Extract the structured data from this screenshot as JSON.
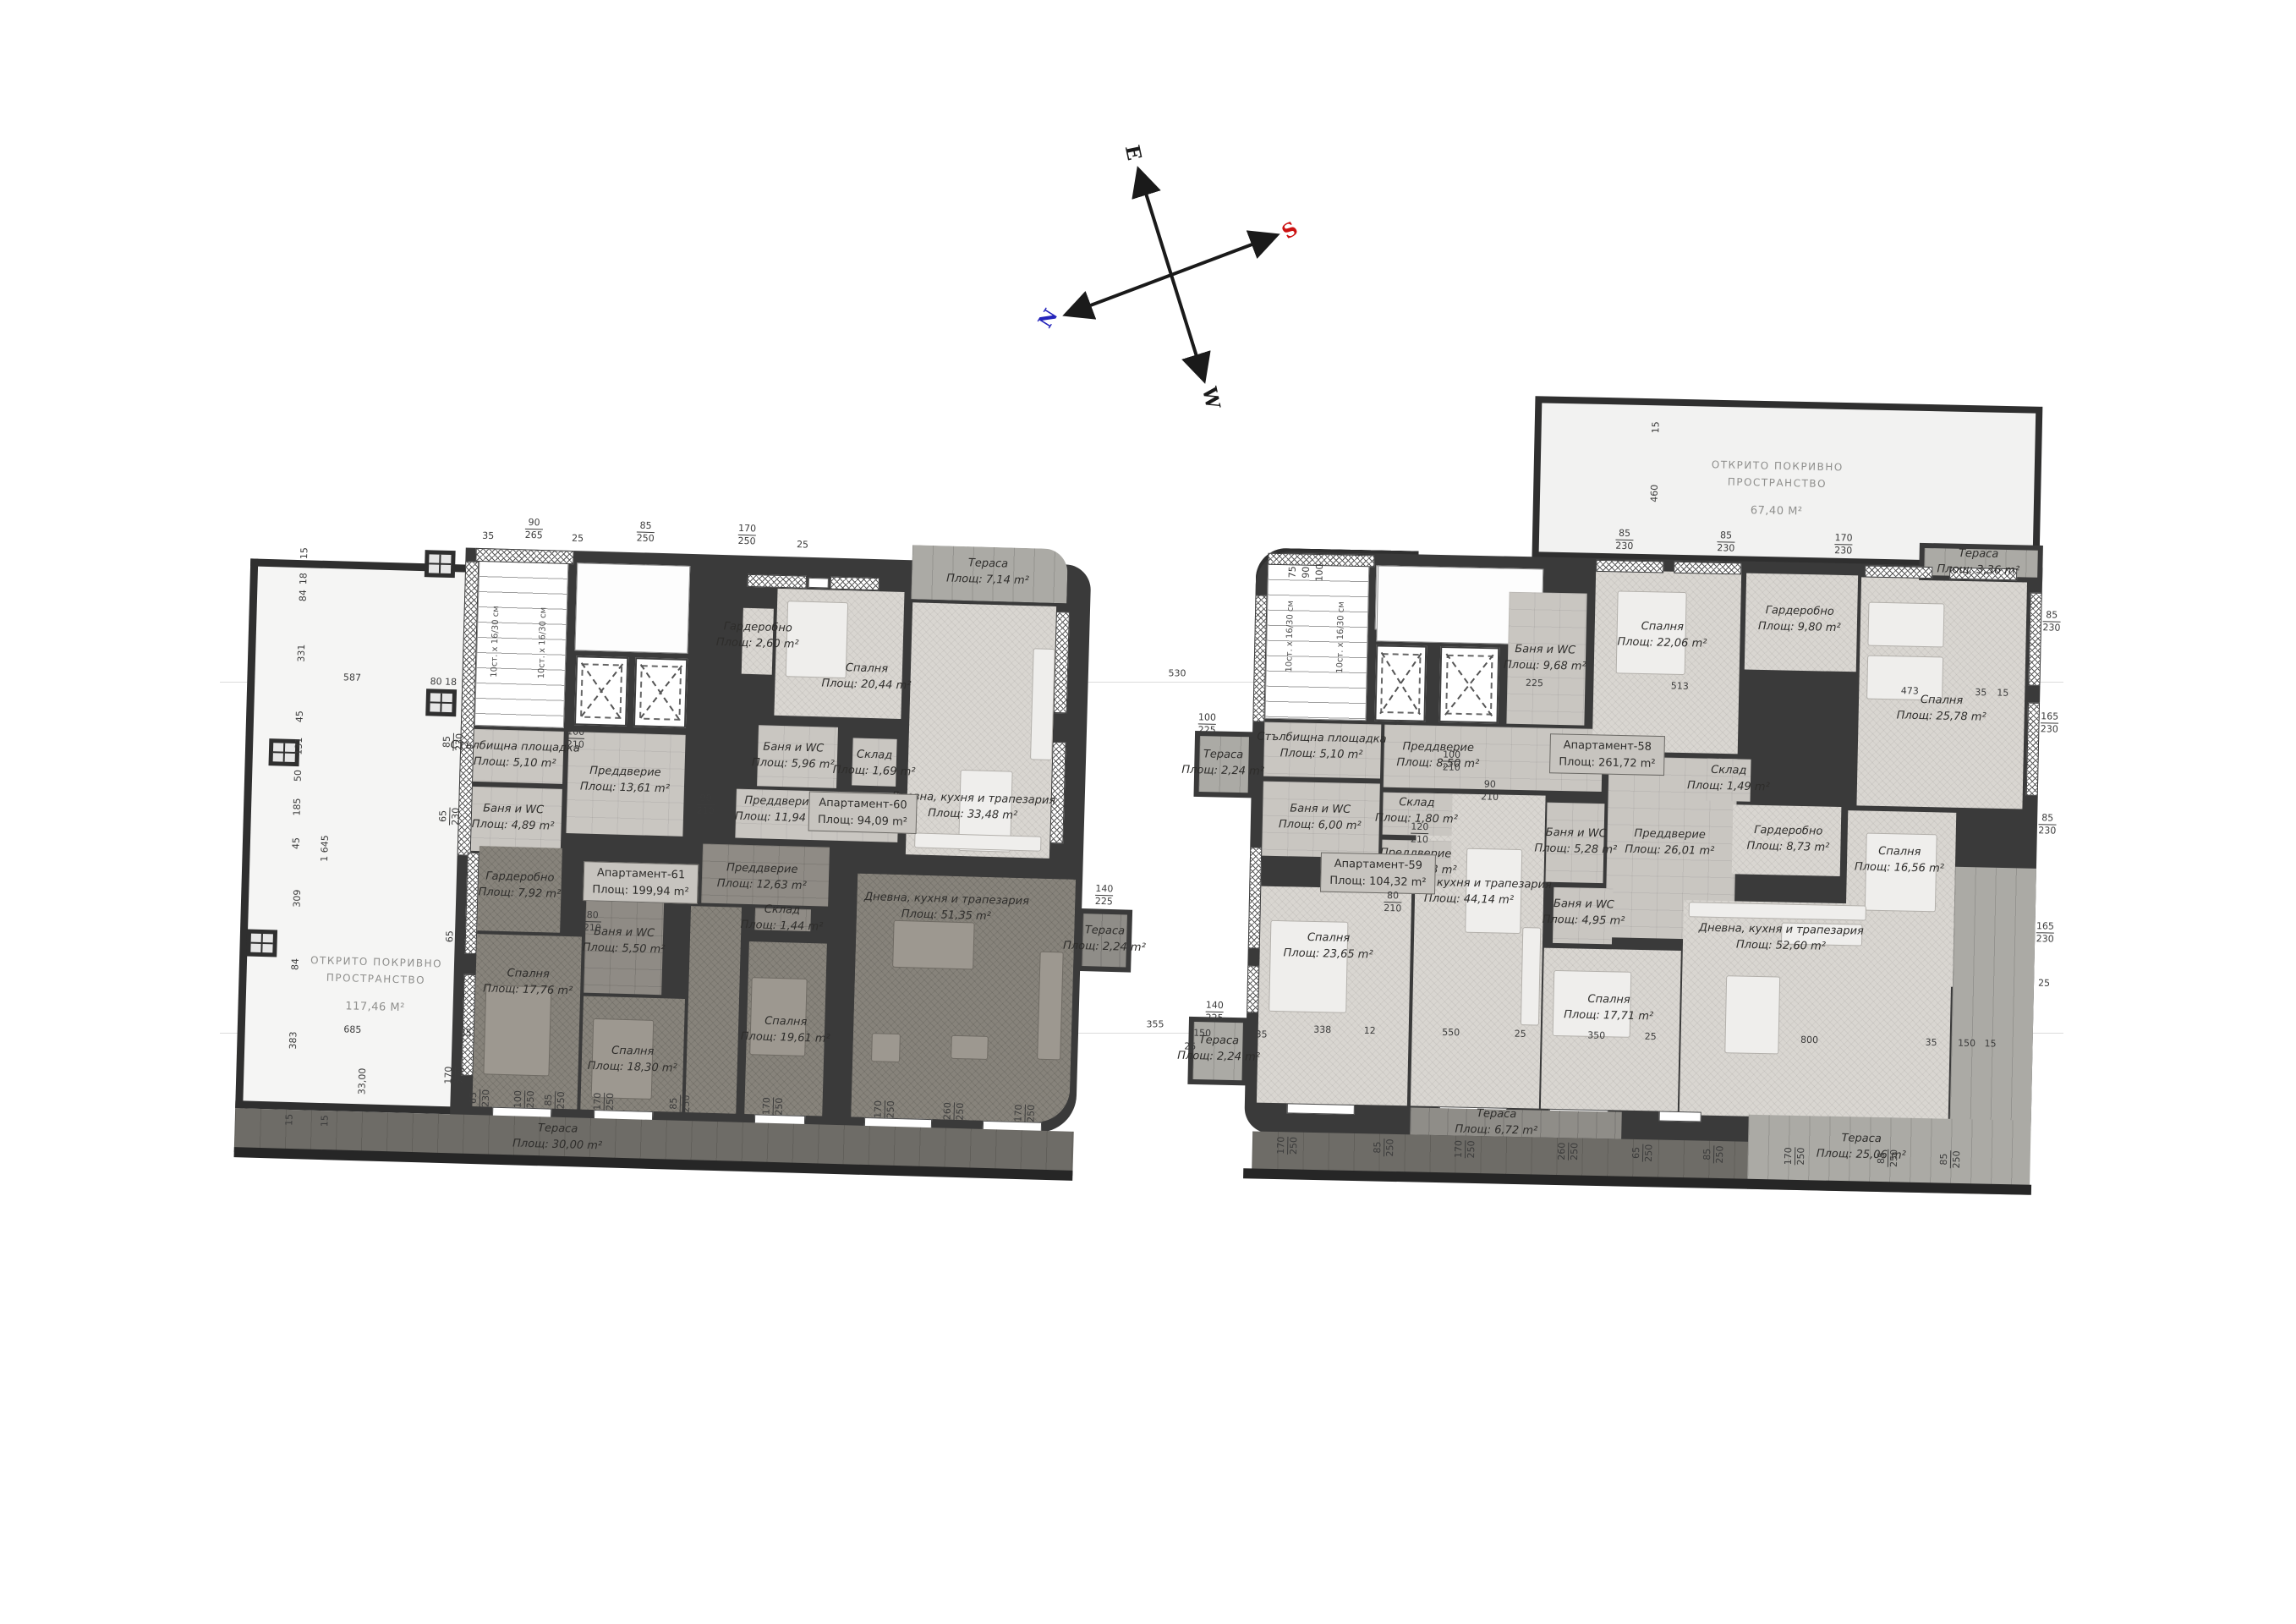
{
  "compass": {
    "labels": {
      "e": "E",
      "s": "S",
      "w": "W",
      "n": "N"
    },
    "colors": {
      "e": "#1a1a1a",
      "s": "#cc1111",
      "w": "#1a1a1a",
      "n": "#2424bb"
    }
  },
  "gap_dims": [
    "530",
    "355"
  ],
  "left_plan": {
    "open_space": {
      "name": "Открито покривно пространство",
      "area": "117,46 m²"
    },
    "stair_flight_text": "10ст. x 16/30 см",
    "apartments": [
      {
        "label": "Апартамент-60",
        "area": "Площ: 94,09 m²"
      },
      {
        "label": "Апартамент-61",
        "area": "Площ: 199,94 m²"
      }
    ],
    "rooms": [
      {
        "name": "Стълбищна площадка",
        "area": "Площ: 5,10 m²"
      },
      {
        "name": "Баня и WC",
        "area": "Площ: 4,89 m²"
      },
      {
        "name": "Преддверие",
        "area": "Площ: 13,61 m²"
      },
      {
        "name": "Гардеробно",
        "area": "Площ: 2,60 m²"
      },
      {
        "name": "Спалня",
        "area": "Площ: 20,44 m²"
      },
      {
        "name": "Баня и WC",
        "area": "Площ: 5,96 m²"
      },
      {
        "name": "Склад",
        "area": "Площ: 1,69 m²"
      },
      {
        "name": "Преддверие",
        "area": "Площ: 11,94 m²"
      },
      {
        "name": "Дневна, кухня и трапезария",
        "area": "Площ: 33,48 m²"
      },
      {
        "name": "Тераса",
        "area": "Площ: 7,14 m²"
      },
      {
        "name": "Гардеробно",
        "area": "Площ: 7,92 m²"
      },
      {
        "name": "Спалня",
        "area": "Площ: 17,76 m²"
      },
      {
        "name": "Баня и WC",
        "area": "Площ: 5,50 m²"
      },
      {
        "name": "Преддверие",
        "area": "Площ: 12,63 m²"
      },
      {
        "name": "Склад",
        "area": "Площ: 1,44 m²"
      },
      {
        "name": "Спалня",
        "area": "Площ: 18,30 m²"
      },
      {
        "name": "Спалня",
        "area": "Площ: 19,61 m²"
      },
      {
        "name": "Дневна, кухня и трапезария",
        "area": "Площ: 51,35 m²"
      },
      {
        "name": "Тераса",
        "area": "Площ: 2,24 m²"
      },
      {
        "name": "Тераса",
        "area": "Площ: 30,00 m²"
      }
    ],
    "dims": [
      "35",
      "90|265",
      "25",
      "85|250",
      "170|250",
      "25",
      "15",
      "18",
      "84",
      "331",
      "45",
      "131",
      "50",
      "185",
      "45",
      "309",
      "84",
      "383",
      "1 645",
      "587",
      "80 18",
      "33,00",
      "685",
      "35",
      "15",
      "15",
      "65|230",
      "100|250",
      "85|250",
      "170|250",
      "85|250",
      "170|250",
      "170|250",
      "260|250",
      "170|250",
      "85|230",
      "65|230",
      "65|230",
      "170|230",
      "140|225",
      "100|210",
      "90|210",
      "80|210"
    ]
  },
  "right_plan": {
    "open_space": {
      "name": "Открито покривно пространство",
      "area": "67,40 m²"
    },
    "stair_flight_text": "10ст. x 16/30 см",
    "apartments": [
      {
        "label": "Апартамент-58",
        "area": "Площ: 261,72 m²"
      },
      {
        "label": "Апартамент-59",
        "area": "Площ: 104,32 m²"
      }
    ],
    "rooms": [
      {
        "name": "Стълбищна площадка",
        "area": "Площ: 5,10 m²"
      },
      {
        "name": "Преддверие",
        "area": "Площ: 8,50 m²"
      },
      {
        "name": "Тераса",
        "area": "Площ: 2,24 m²"
      },
      {
        "name": "Баня и WC",
        "area": "Площ: 6,00 m²"
      },
      {
        "name": "Преддверие",
        "area": "Площ: 5,93 m²"
      },
      {
        "name": "Склад",
        "area": "Площ: 1,80 m²"
      },
      {
        "name": "Спалня",
        "area": "Площ: 23,65 m²"
      },
      {
        "name": "Дневна, кухня и трапезария",
        "area": "Площ: 44,14 m²"
      },
      {
        "name": "Тераса",
        "area": "Площ: 6,72 m²"
      },
      {
        "name": "Тераса",
        "area": "Площ: 2,24 m²"
      },
      {
        "name": "Баня и WC",
        "area": "Площ: 9,68 m²"
      },
      {
        "name": "Спалня",
        "area": "Площ: 22,06 m²"
      },
      {
        "name": "Гардеробно",
        "area": "Площ: 9,80 m²"
      },
      {
        "name": "Спалня",
        "area": "Площ: 25,78 m²"
      },
      {
        "name": "Тераса",
        "area": "Площ: 3,36 m²"
      },
      {
        "name": "Баня и WC",
        "area": "Площ: 5,28 m²"
      },
      {
        "name": "Баня и WC",
        "area": "Площ: 4,95 m²"
      },
      {
        "name": "Спалня",
        "area": "Площ: 17,71 m²"
      },
      {
        "name": "Преддверие",
        "area": "Площ: 26,01 m²"
      },
      {
        "name": "Склад",
        "area": "Площ: 1,49 m²"
      },
      {
        "name": "Гардеробно",
        "area": "Площ: 8,73 m²"
      },
      {
        "name": "Спалня",
        "area": "Площ: 16,56 m²"
      },
      {
        "name": "Дневна, кухня и трапезария",
        "area": "Площ: 52,60 m²"
      },
      {
        "name": "Тераса",
        "area": "Площ: 25,06 m²"
      }
    ],
    "dims": [
      "15",
      "460",
      "75",
      "90",
      "100",
      "85|230",
      "85|230",
      "170|230",
      "85|230",
      "165|230",
      "85|230",
      "165|230",
      "25",
      "225",
      "513",
      "473",
      "35",
      "15",
      "338",
      "12",
      "550",
      "25",
      "350",
      "25",
      "800",
      "35",
      "150",
      "15",
      "170|250",
      "85|250",
      "170|250",
      "260|250",
      "65|250",
      "85|250",
      "170|250",
      "85|250",
      "85|250",
      "100|225",
      "140|225",
      "150",
      "25",
      "35",
      "100|210",
      "80|210",
      "90|210",
      "120|210"
    ]
  }
}
